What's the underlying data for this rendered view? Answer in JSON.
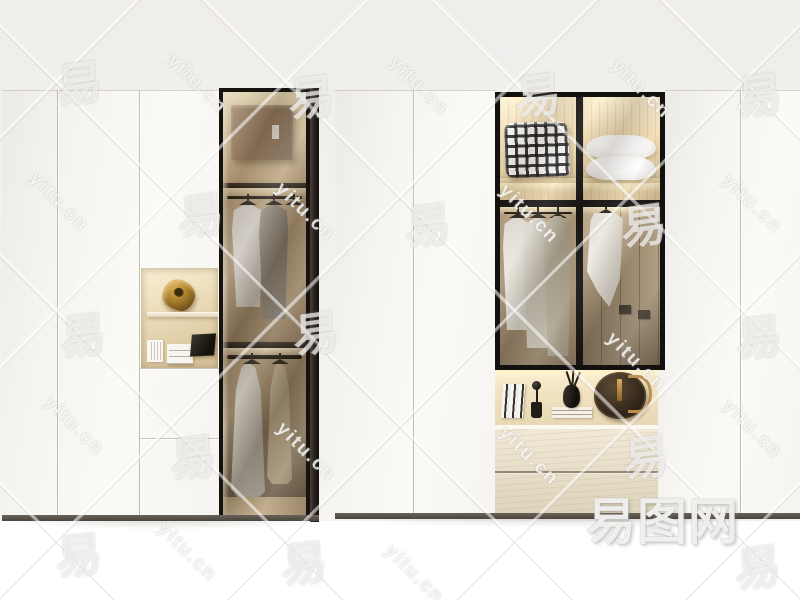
{
  "watermark": {
    "site_text": "yitu.cn",
    "glyph": "易",
    "logo_text": "易图网",
    "text_color": "#ffffff"
  },
  "scene": {
    "description": "Two modern wardrobe cabinets: matte white doors with black-framed smoked-glass display sections and warm LED-lit beige interiors, on white floor",
    "background_color": "#f2f0ed",
    "floor_color": "#ffffff",
    "frame_color": "#141210",
    "interior_wood_color": "#d9c49e",
    "plinth_color": "#5b544c",
    "led_color": "#ffedc2",
    "left_wardrobe": {
      "door_panels": 3,
      "niche_items": [
        "gold-abstract-sculpture",
        "miniature-white-chair",
        "miniature-drawer-chest",
        "dark-tablet"
      ],
      "glass_column_items": [
        "storage-box",
        "white-shirt",
        "grey-coat",
        "empty-hanger",
        "long-grey-dress",
        "long-beige-dress"
      ]
    },
    "right_wardrobe": {
      "door_panels": 4,
      "glass_top_items": [
        "black-white-checkered-cushion",
        "two-white-pillows"
      ],
      "glass_bottom_items": [
        "white-shirt",
        "light-grey-shirt",
        "grey-coat",
        "white-hanging-towel",
        "interior-doors-with-handles"
      ],
      "open_shelf_items": [
        "upright-books",
        "black-sphere-ornament",
        "white-book-stack",
        "black-vase-with-branches",
        "round-brown-leather-bag"
      ],
      "drawer_count": 2
    }
  }
}
